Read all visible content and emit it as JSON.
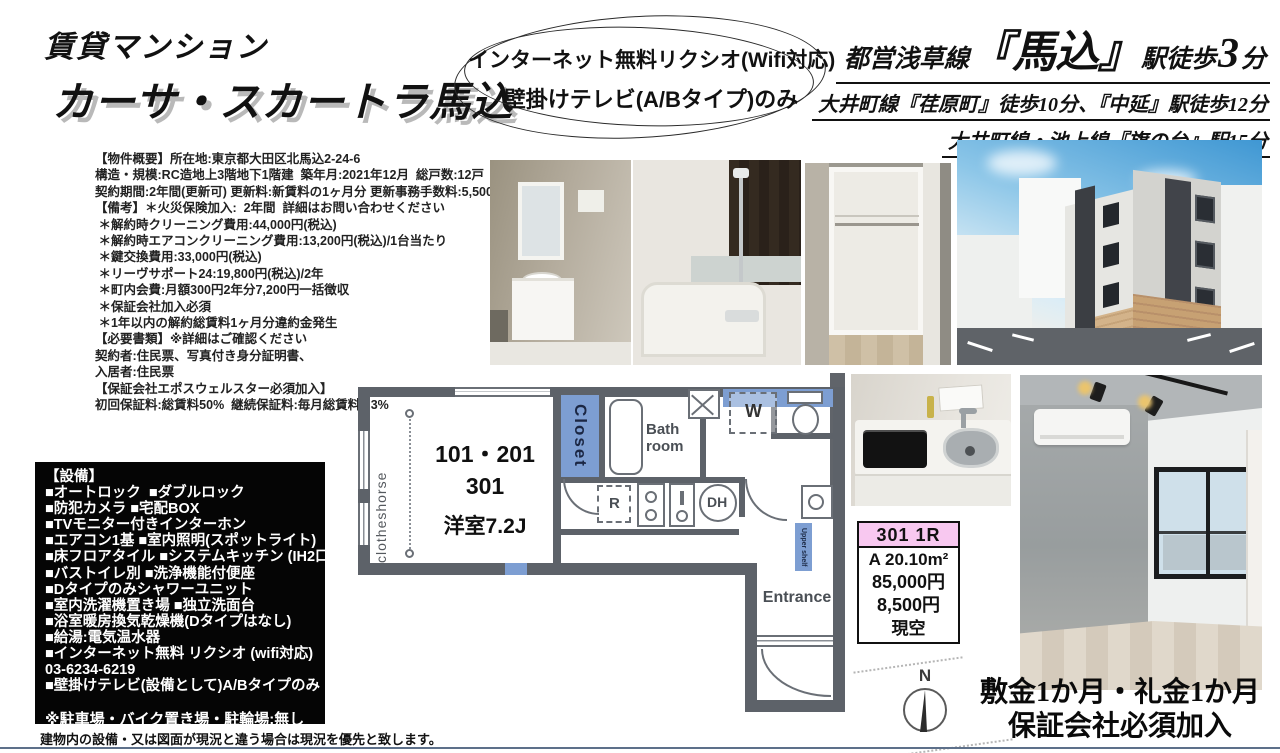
{
  "colors": {
    "floorplan_accent_blue": "#7d9ed2",
    "floorplan_wall_gray": "#5d6269",
    "price_header_pink": "#f8c8f0",
    "equipment_box_bg": "#050505",
    "bottom_rule_blue_gray": "#5d708a"
  },
  "header": {
    "title_small": "賃貸マンション",
    "title_main": "カーサ・スカートラ馬込"
  },
  "highlight": {
    "line1": "インターネット無料リクシオ(Wifi対応)",
    "line2": "壁掛けテレビ(A/Bタイプ)のみ"
  },
  "access": {
    "line1_prefix": "都営浅草線",
    "line1_station": "『馬込』",
    "line1_mid": "駅徒歩",
    "line1_minutes": "3",
    "line1_suffix": "分",
    "line2": "大井町線『荏原町』徒歩10分、『中延』駅徒歩12分",
    "line3": "大井町線・池上線『旗の台』駅15分"
  },
  "overview": {
    "lines": [
      "【物件概要】所在地:東京都大田区北馬込2-24-6",
      "構造・規模:RC造地上3階地下1階建  築年月:2021年12月  総戸数:12戸",
      "契約期間:2年間(更新可) 更新料:新賃料の1ヶ月分 更新事務手数料:5,500円(税込)",
      "【備考】＊火災保険加入:  2年間  詳細はお問い合わせください",
      " ＊解約時クリーニング費用:44,000円(税込)",
      " ＊解約時エアコンクリーニング費用:13,200円(税込)/1台当たり",
      " ＊鍵交換費用:33,000円(税込)",
      " ＊リーヴサポート24:19,800円(税込)/2年",
      " ＊町内会費:月額300円2年分7,200円一括徴収",
      " ＊保証会社加入必須",
      " ＊1年以内の解約総賃料1ヶ月分違約金発生",
      "【必要書類】※詳細はご確認ください",
      "契約者:住民票、写真付き身分証明書、",
      "入居者:住民票",
      "【保証会社エポスウェルスター必須加入】",
      "初回保証料:総賃料50%  継続保証料:毎月総賃料1.3%"
    ]
  },
  "equipment": {
    "lines": [
      "【設備】",
      "■オートロック  ■ダブルロック",
      "■防犯カメラ ■宅配BOX",
      "■TVモニター付きインターホン",
      "■エアコン1基 ■室内照明(スポットライト)",
      "■床フロアタイル ■システムキッチン (IH2口)",
      "■バストイレ別 ■洗浄機能付便座",
      "■Dタイプのみシャワーユニット",
      "■室内洗濯機置き場 ■独立洗面台",
      "■浴室暖房換気乾燥機(Dタイプはなし)",
      "■給湯:電気温水器",
      "■インターネット無料 リクシオ (wifi対応)",
      "03-6234-6219",
      "■壁掛けテレビ(設備として)A/Bタイプのみ"
    ],
    "note": "※駐車場・バイク置き場・駐輪場:無し"
  },
  "floorplan": {
    "clotheshorse": "clotheshorse",
    "closet": "Closet",
    "bathroom": "Bath room",
    "refrigerator": "R",
    "washer": "W",
    "dh": "DH",
    "upper_shelf": "Upper shelf",
    "entrance": "Entrance",
    "units_12": "101・201",
    "unit_3": "301",
    "room_size": "洋室7.2J",
    "compass_n": "N"
  },
  "price_card": {
    "header": "301  1R",
    "area": "A  20.10m²",
    "rent": "85,000円",
    "fee": "8,500円",
    "status": "現空"
  },
  "terms": {
    "line1": "敷金1か月・礼金1か月",
    "line2": "保証会社必須加入"
  },
  "footnote": "建物内の設備・又は図面が現況と違う場合は現況を優先と致します。"
}
